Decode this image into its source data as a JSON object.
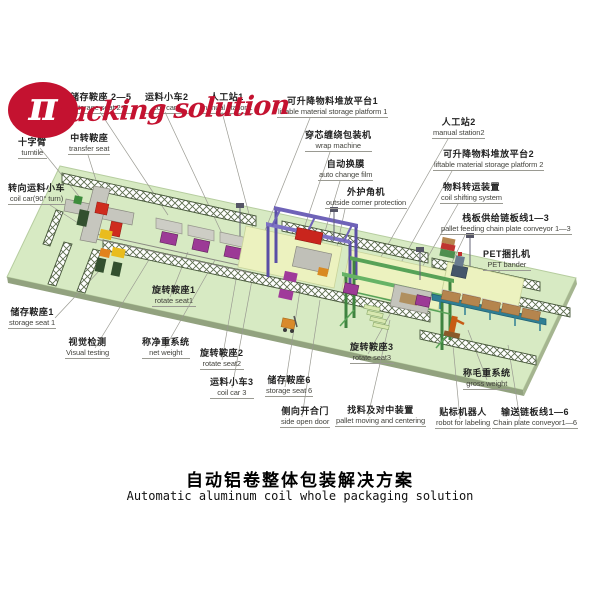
{
  "logo": {
    "symbol": "π",
    "script": "packing solution",
    "brand_red": "#c41230"
  },
  "title": {
    "zh": "自动铝卷整体包装解决方案",
    "en": "Automatic aluminum coil whole packaging solution"
  },
  "colors": {
    "platform_green": "#d7eac3",
    "platform_edge": "#92a27f",
    "rail_hatch": "#5d6d4e",
    "saddle_magenta": "#9c3a96",
    "wrap_gantry_purple": "#6f63b8",
    "shift_gantry_green": "#57a257",
    "conveyor_teal": "#2f7e94",
    "pallet_tan": "#b5854e",
    "leader_gray": "#9a9a92"
  },
  "diagram": {
    "labels": [
      {
        "id": "storage-seat-2-5",
        "zh": "储存鞍座 2—5",
        "en": "storage seat 2-5",
        "x": 70,
        "y": 92
      },
      {
        "id": "coil-car-2",
        "zh": "运料小车2",
        "en": "coil car2",
        "x": 145,
        "y": 92
      },
      {
        "id": "manual-station-1",
        "zh": "人工站1",
        "en": "manual station1",
        "x": 200,
        "y": 92
      },
      {
        "id": "liftable-platform-1",
        "zh": "可升降物料堆放平台1",
        "en": "liftable material storage platform 1",
        "x": 277,
        "y": 96
      },
      {
        "id": "wrap-machine",
        "zh": "穿芯缠绕包装机",
        "en": "wrap machine",
        "x": 305,
        "y": 130
      },
      {
        "id": "auto-change-film",
        "zh": "自动换膜",
        "en": "auto change film",
        "x": 318,
        "y": 159
      },
      {
        "id": "outside-corner-protection",
        "zh": "外护角机",
        "en": "outside corner protection",
        "x": 325,
        "y": 187
      },
      {
        "id": "manual-station-2",
        "zh": "人工站2",
        "en": "manual station2",
        "x": 432,
        "y": 117
      },
      {
        "id": "liftable-platform-2",
        "zh": "可升降物料堆放平台2",
        "en": "liftable material storage platform 2",
        "x": 433,
        "y": 149
      },
      {
        "id": "coil-shifting-system",
        "zh": "物料转运装置",
        "en": "coil shifting system",
        "x": 440,
        "y": 182
      },
      {
        "id": "pallet-feeding-conveyor",
        "zh": "栈板供给链板线1—3",
        "en": "pallet feeding chain plate conveyor 1—3",
        "x": 440,
        "y": 213
      },
      {
        "id": "pet-bander",
        "zh": "PET捆扎机",
        "en": "PET bander",
        "x": 483,
        "y": 249
      },
      {
        "id": "turntile",
        "zh": "十字臂",
        "en": "turntile",
        "x": 18,
        "y": 137
      },
      {
        "id": "transfer-seat",
        "zh": "中转鞍座",
        "en": "transfer seat",
        "x": 68,
        "y": 133
      },
      {
        "id": "coil-car-90-turn",
        "zh": "转向运料小车",
        "en": "coil car(90° turn)",
        "x": 8,
        "y": 183
      },
      {
        "id": "storage-seat-1",
        "zh": "储存鞍座1",
        "en": "storage seat 1",
        "x": 8,
        "y": 307
      },
      {
        "id": "visual-testing",
        "zh": "视觉检测",
        "en": "Visual testing",
        "x": 65,
        "y": 337
      },
      {
        "id": "rotate-seat-1",
        "zh": "旋转鞍座1",
        "en": "rotate seat1",
        "x": 152,
        "y": 285
      },
      {
        "id": "net-weight",
        "zh": "称净重系统",
        "en": "net weight",
        "x": 142,
        "y": 337
      },
      {
        "id": "rotate-seat-2",
        "zh": "旋转鞍座2",
        "en": "rotate seat2",
        "x": 200,
        "y": 348
      },
      {
        "id": "coil-car-3",
        "zh": "运料小车3",
        "en": "coil car 3",
        "x": 210,
        "y": 377
      },
      {
        "id": "storage-seat-6",
        "zh": "储存鞍座6",
        "en": "storage seat 6",
        "x": 265,
        "y": 375
      },
      {
        "id": "side-open-door",
        "zh": "侧向开合门",
        "en": "side open door",
        "x": 280,
        "y": 406
      },
      {
        "id": "pallet-moving-centering",
        "zh": "找料及对中装置",
        "en": "pallet moving and centering",
        "x": 335,
        "y": 405
      },
      {
        "id": "rotate-seat-3",
        "zh": "旋转鞍座3",
        "en": "rotate seat3",
        "x": 350,
        "y": 342
      },
      {
        "id": "gross-weight",
        "zh": "称毛重系统",
        "en": "gross weight",
        "x": 463,
        "y": 368
      },
      {
        "id": "robot-for-labeling",
        "zh": "贴标机器人",
        "en": "robot for labeling",
        "x": 435,
        "y": 407
      },
      {
        "id": "chain-plate-conveyor",
        "zh": "输送链板线1—6",
        "en": "Chain plate conveyor1—6",
        "x": 492,
        "y": 407
      }
    ],
    "leaders": [
      [
        100,
        112,
        168,
        215
      ],
      [
        165,
        112,
        225,
        240
      ],
      [
        222,
        112,
        258,
        248
      ],
      [
        310,
        118,
        262,
        238
      ],
      [
        330,
        152,
        300,
        240
      ],
      [
        340,
        181,
        318,
        255
      ],
      [
        345,
        209,
        332,
        270
      ],
      [
        448,
        139,
        378,
        262
      ],
      [
        452,
        171,
        398,
        268
      ],
      [
        458,
        204,
        412,
        285
      ],
      [
        465,
        235,
        438,
        292
      ],
      [
        500,
        271,
        468,
        292
      ],
      [
        40,
        148,
        82,
        200
      ],
      [
        88,
        155,
        108,
        218
      ],
      [
        50,
        205,
        92,
        232
      ],
      [
        55,
        318,
        100,
        270
      ],
      [
        95,
        348,
        150,
        258
      ],
      [
        170,
        297,
        188,
        252
      ],
      [
        165,
        348,
        215,
        260
      ],
      [
        222,
        360,
        238,
        268
      ],
      [
        232,
        388,
        252,
        280
      ],
      [
        285,
        387,
        300,
        290
      ],
      [
        302,
        417,
        320,
        300
      ],
      [
        368,
        416,
        390,
        320
      ],
      [
        368,
        354,
        398,
        300
      ],
      [
        487,
        380,
        468,
        330
      ],
      [
        460,
        419,
        452,
        335
      ],
      [
        520,
        419,
        508,
        345
      ]
    ]
  }
}
